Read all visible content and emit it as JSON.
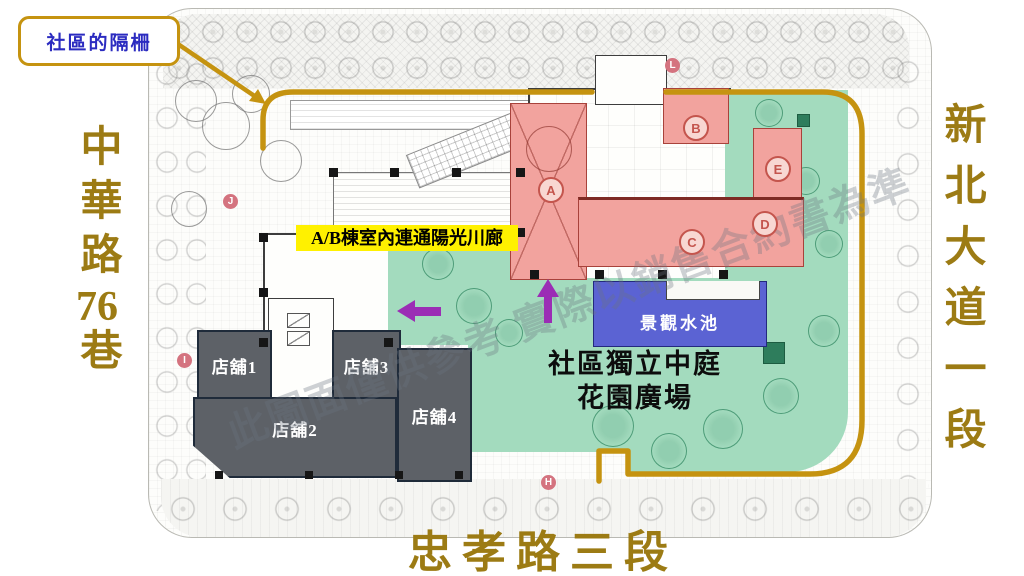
{
  "callout": {
    "label": "社區的隔柵"
  },
  "roads": {
    "left_part1": "中華路",
    "left_num": "76",
    "left_part2": "巷",
    "right": "新北大道一段",
    "bottom": "忠孝路三段"
  },
  "map": {
    "corridor_label": "A/B棟室內連通陽光川廊",
    "courtyard": {
      "line1": "社區獨立中庭",
      "line2": "花園廣場"
    },
    "pool_label": "景觀水池",
    "shops": [
      {
        "label": "店舖1"
      },
      {
        "label": "店舖2"
      },
      {
        "label": "店舖3"
      },
      {
        "label": "店舖4"
      }
    ],
    "unit_markers": {
      "a": "A",
      "b": "B",
      "c": "C",
      "d": "D",
      "e": "E"
    },
    "street_markers": {
      "j": "J",
      "i": "I",
      "l": "L",
      "h": "H"
    },
    "watermark": "此圖面僅供參考 實際以銷售合約書為準",
    "colors": {
      "gold_line": "#C59310",
      "road_text": "#9C7B14",
      "callout_text": "#2B2BC0",
      "corridor_bg": "#FFF100",
      "building_pink": "#F2A39E",
      "garden_green": "#A3DBBE",
      "pool_blue": "#5B63D3",
      "shop_gray": "#5D6167",
      "arrow_purple": "#9B2DB5",
      "marker_rose": "#D4737F"
    }
  }
}
